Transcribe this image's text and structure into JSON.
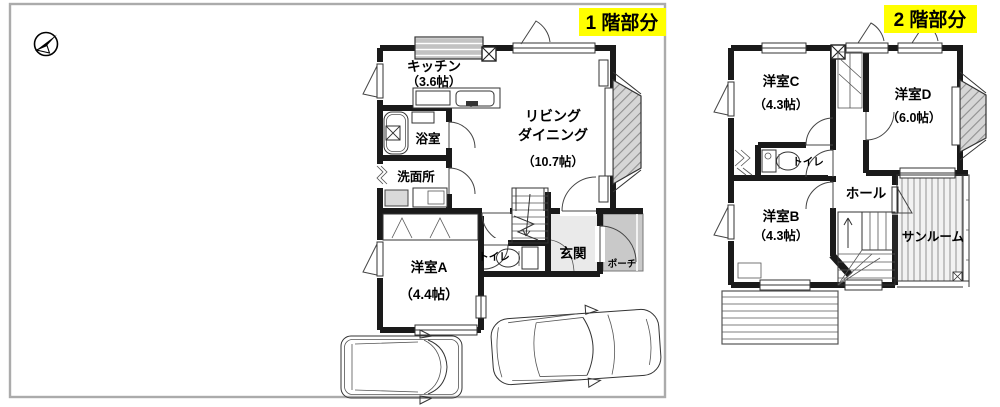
{
  "meta": {
    "description": "Japanese real-estate floor plan, 1st and 2nd floor, with two cars in parking area and a north compass"
  },
  "colors": {
    "highlight": "#ffff00",
    "wall": "#1a1a1a",
    "frame_border": "#ababab",
    "porch_fill": "#c9c9c9",
    "entrance_fill": "#eaeaea",
    "glass_fill": "#cccccc",
    "appliance_fill": "#d9d9d9"
  },
  "floor1": {
    "tag": "1 階部分",
    "kitchen_name": "キッチン",
    "kitchen_size": "（3.6帖）",
    "living_line1": "リビング",
    "living_line2": "ダイニング",
    "living_size": "（10.7帖）",
    "bath_name": "浴室",
    "washroom_name": "洗面所",
    "room_a_name": "洋室A",
    "room_a_size": "（4.4帖）",
    "toilet_name": "トイレ",
    "entrance_name": "玄関",
    "porch_name": "ポーチ"
  },
  "floor2": {
    "tag": "2 階部分",
    "room_c_name": "洋室C",
    "room_c_size": "（4.3帖）",
    "room_d_name": "洋室D",
    "room_d_size": "（6.0帖）",
    "toilet_name": "トイレ",
    "hall_name": "ホール",
    "room_b_name": "洋室B",
    "room_b_size": "（4.3帖）",
    "sunroom_name": "サンルーム"
  }
}
